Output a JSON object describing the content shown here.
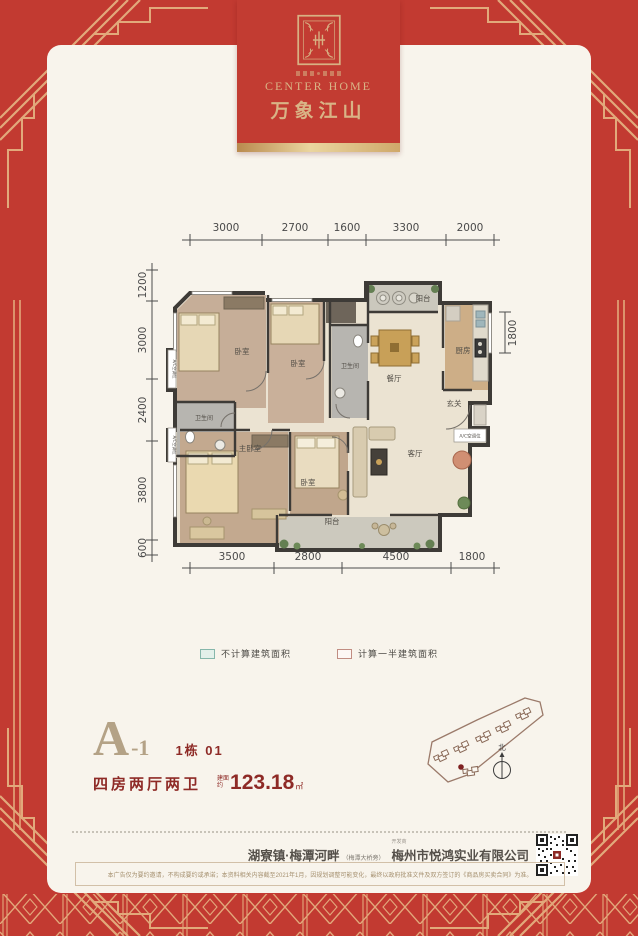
{
  "colors": {
    "brand_red": "#c23a31",
    "ornament_gold": "#e2a97b",
    "card_bg": "#f8f4ec",
    "accent_dark_red": "#8e2a26",
    "accent_tan": "#b4a286"
  },
  "banner": {
    "brand_en": "CENTER HOME",
    "brand_cn": "万象江山"
  },
  "floor_plan": {
    "dims_top": [
      "3000",
      "2700",
      "1600",
      "3300",
      "2000"
    ],
    "dims_left": [
      "1200",
      "3000",
      "2400",
      "3800",
      "600"
    ],
    "dims_bottom": [
      "3500",
      "2800",
      "4500",
      "1800"
    ],
    "dim_right": "1800",
    "rooms": {
      "bedroom_a": "卧室",
      "bedroom_b": "卧室",
      "bath_a": "卫生间",
      "dining": "餐厅",
      "kitchen": "厨房",
      "foyer": "玄关",
      "bath_b": "卫生间",
      "master": "主卧室",
      "bedroom_c": "卧室",
      "living": "客厅",
      "balcony_top": "阳台",
      "balcony_bottom": "阳台"
    },
    "ac_label": "A/C空调位"
  },
  "legend": {
    "items": [
      {
        "label": "不计算建筑面积",
        "fill": "#e3f0ea",
        "stroke": "#86b7ab"
      },
      {
        "label": "计算一半建筑面积",
        "fill": "#fdf7f4",
        "stroke": "#c18d82"
      }
    ]
  },
  "unit": {
    "name": "A",
    "suffix": "-1",
    "block": "1栋 01",
    "layout": "四房两厅两卫",
    "area_prefix_1": "建面",
    "area_prefix_2": "约",
    "area_value": "123.18",
    "area_unit": "㎡"
  },
  "siteplan": {
    "north": "北"
  },
  "footer": {
    "address": "湖寮镇·梅潭河畔",
    "address_note": "（梅潭大桥旁）",
    "developer_label": "开发商",
    "developer": "梅州市悦鸿实业有限公司",
    "disclaimer": "本广告仅为要约邀请，不构成要约或承诺；本资料相关内容截至2021年1月，因规划调整可能变化，最终以政府批准文件及双方签订的《商品房买卖合同》为准。"
  }
}
